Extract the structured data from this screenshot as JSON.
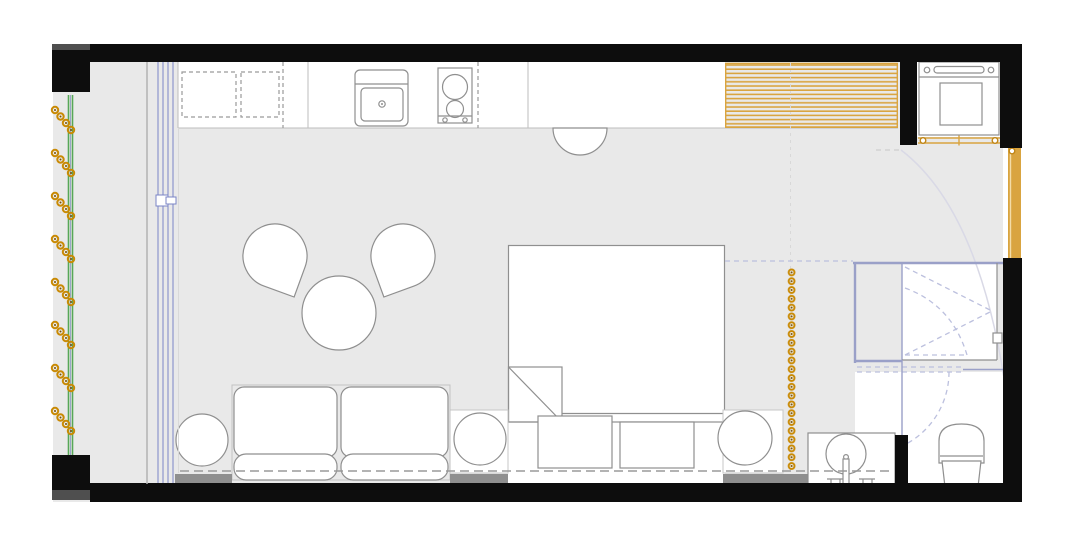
{
  "canvas": {
    "width": 1077,
    "height": 547
  },
  "palette": {
    "floor": "#e9e9e9",
    "wall": "#0d0d0d",
    "wallShade": "#4f4f4f",
    "outline": "#8f8f8f",
    "outlineLight": "#bdbdbd",
    "white": "#ffffff",
    "gold": "#d9a440",
    "goldDeep": "#c08618",
    "orange": "#c98a05",
    "orangeDark": "#7a5203",
    "green": "#57a757",
    "blue": "#7b85c6",
    "lavender": "#9aa0c8",
    "lavenderDash": "#bcc0de",
    "grayStrip": "#8f8f8f",
    "dash": "#9a9a9a",
    "faint": "#d9d9e6"
  },
  "plan": {
    "type": "studio-apartment-floor-plan",
    "rooms": [
      "balcony",
      "kitchen",
      "living-sleeping-area",
      "entry",
      "bathroom",
      "laundry-niche"
    ],
    "furniture": [
      "upper-cabinets-dashed",
      "kitchen-sink",
      "two-burner-cooktop",
      "half-round-table",
      "slatted-wardrobe",
      "washing-machine",
      "lounge-chair-left",
      "lounge-chair-right",
      "round-coffee-table",
      "two-seat-sofa",
      "side-table-left",
      "side-table-center",
      "side-table-right",
      "double-bed",
      "blanket-fold",
      "floor-cushion-left",
      "floor-cushion-right"
    ],
    "fixtures": [
      "entry-door-gold",
      "niche-folding-door-gold",
      "sliding-glass-door",
      "balcony-railing",
      "shower-enclosure",
      "shower-folding-door",
      "wc-sliding-door",
      "toilet",
      "vanity-counter",
      "round-basin",
      "faucet"
    ],
    "symbols": {
      "plant_clusters": 8,
      "plant_dots_per_cluster": 4,
      "curtain_dot_count": 23,
      "curtain_orientation": "vertical",
      "wardrobe_slats": "horizontal-gold-stripes"
    }
  }
}
